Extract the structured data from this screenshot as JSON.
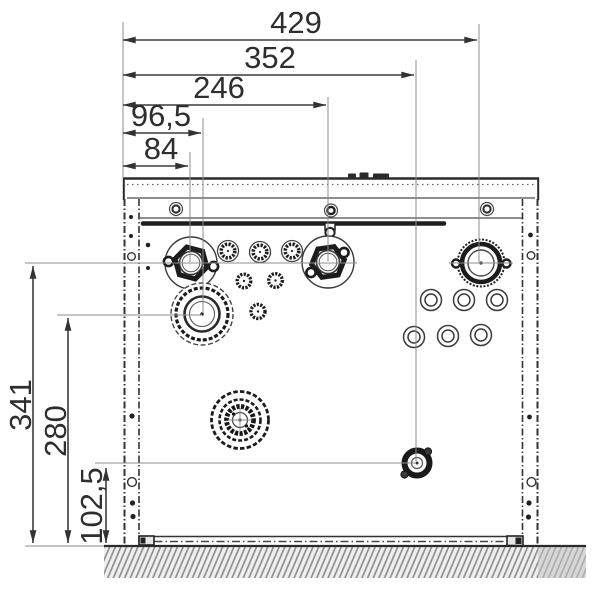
{
  "drawing": {
    "type": "technical-dimension-drawing-bottom-view",
    "dims_top": [
      {
        "name": "width-total",
        "label": "429"
      },
      {
        "name": "width-352",
        "label": "352"
      },
      {
        "name": "width-246",
        "label": "246"
      },
      {
        "name": "width-96-5",
        "label": "96,5"
      },
      {
        "name": "width-84",
        "label": "84"
      }
    ],
    "dims_left": [
      {
        "name": "height-341",
        "label": "341"
      },
      {
        "name": "height-280",
        "label": "280"
      },
      {
        "name": "height-102-5",
        "label": "102,5"
      }
    ],
    "components": [
      "hex-union-left",
      "hex-union-middle",
      "knurled-union-right",
      "small-caps-row",
      "blanked-ports",
      "large-flue-connection-left",
      "large-connection-bottom",
      "grommet-grid-right",
      "small-valve-bottom",
      "ground-hatch"
    ],
    "colors": {
      "line": "#2b2b2b",
      "dim_line": "#3d3d3d",
      "text": "#2e2e2e",
      "construction": "#8c8c8c",
      "hatch": "#8f8f8f",
      "ground_gray": "#c4c4c4",
      "background": "#ffffff"
    }
  }
}
